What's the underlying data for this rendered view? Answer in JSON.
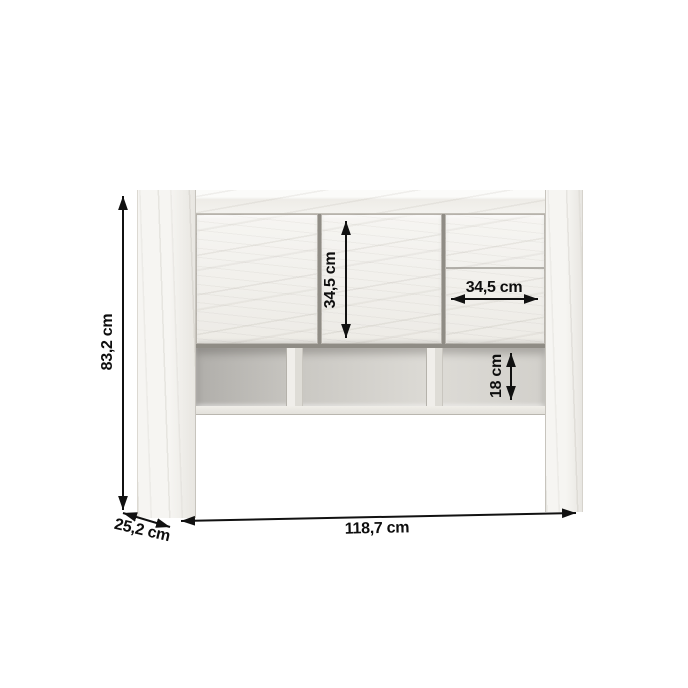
{
  "diagram": {
    "background_color": "#ffffff",
    "dimension_line_color": "#111111",
    "wood_color": "#f2f1ed",
    "shelf_interior_color": "#c9c7c2",
    "labels": {
      "overall_height": "83,2 cm",
      "door_height": "34,5 cm",
      "drawer_width": "34,5 cm",
      "shelf_opening_height": "18 cm",
      "overall_width": "118,7 cm",
      "depth": "25,2 cm"
    }
  }
}
